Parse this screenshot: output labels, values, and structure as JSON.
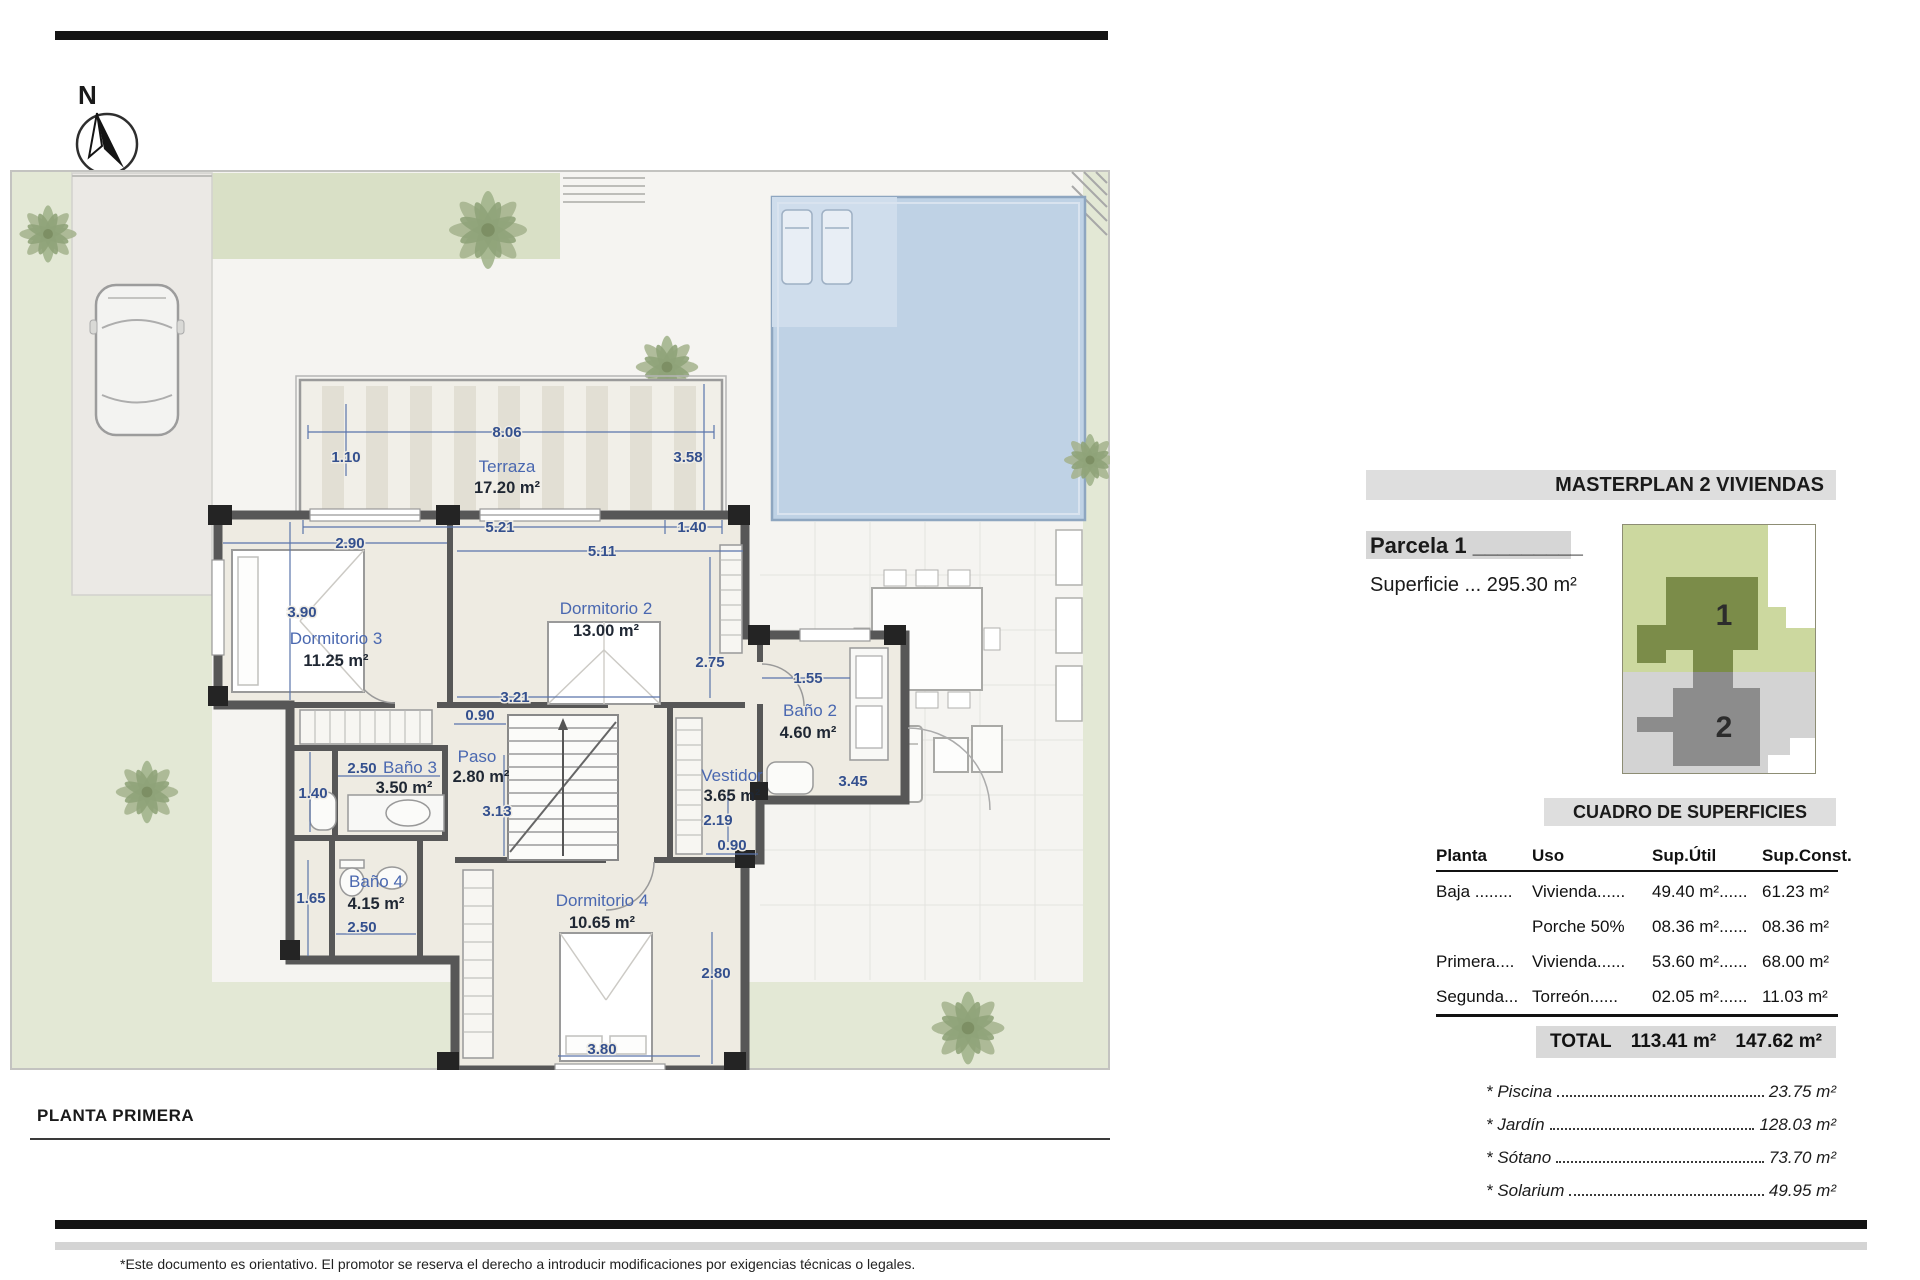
{
  "compass": {
    "north_label": "N"
  },
  "plan": {
    "title": "PLANTA PRIMERA",
    "rooms": {
      "terraza": {
        "name": "Terraza",
        "area": "17.20 m²"
      },
      "dorm3": {
        "name": "Dormitorio 3",
        "area": "11.25 m²"
      },
      "dorm2": {
        "name": "Dormitorio 2",
        "area": "13.00 m²"
      },
      "bano2": {
        "name": "Baño 2",
        "area": "4.60 m²"
      },
      "bano3": {
        "name": "Baño 3",
        "area": "3.50 m²"
      },
      "paso": {
        "name": "Paso",
        "area": "2.80 m²"
      },
      "vestidor": {
        "name": "Vestidor",
        "area": "3.65 m²"
      },
      "bano4": {
        "name": "Baño 4",
        "area": "4.15 m²"
      },
      "dorm4": {
        "name": "Dormitorio 4",
        "area": "10.65 m²"
      }
    },
    "dims": {
      "d806": "8.06",
      "d110": "1.10",
      "d358": "3.58",
      "d521": "5.21",
      "d140a": "1.40",
      "d290": "2.90",
      "d390": "3.90",
      "d511": "5.11",
      "d321": "3.21",
      "d275": "2.75",
      "d155": "1.55",
      "d345": "3.45",
      "d090a": "0.90",
      "d250a": "2.50",
      "d140b": "1.40",
      "d313": "3.13",
      "d219": "2.19",
      "d090b": "0.90",
      "d165": "1.65",
      "d250b": "2.50",
      "d280": "2.80",
      "d380": "3.80"
    }
  },
  "panel": {
    "masterplan_title": "MASTERPLAN 2 VIVIENDAS",
    "parcela": "Parcela 1 _________",
    "superficie": "Superficie ... 295.30 m²",
    "plot1": "1",
    "plot2": "2",
    "cuadro_title": "CUADRO DE SUPERFICIES",
    "table": {
      "headers": [
        "Planta",
        "Uso",
        "Sup.Útil",
        "Sup.Const."
      ],
      "rows": [
        [
          "Baja ........",
          "Vivienda......",
          "49.40 m²......",
          "61.23 m²"
        ],
        [
          "",
          "Porche 50%",
          "08.36 m²......",
          "08.36 m²"
        ],
        [
          "Primera....",
          "Vivienda......",
          "53.60 m²......",
          "68.00 m²"
        ],
        [
          "Segunda...",
          "Torreón......",
          "02.05 m²......",
          "11.03 m²"
        ]
      ]
    },
    "total": {
      "label": "TOTAL",
      "util": "113.41 m²",
      "constr": "147.62 m²"
    },
    "extras": [
      {
        "label": "* Piscina",
        "value": "23.75 m²"
      },
      {
        "label": "* Jardín",
        "value": "128.03 m²"
      },
      {
        "label": "* Sótano",
        "value": "73.70 m²"
      },
      {
        "label": "* Solarium",
        "value": "49.95 m²"
      }
    ]
  },
  "footer": {
    "note": "*Este documento es orientativo. El promotor se reserva el derecho a introducir modificaciones por exigencias técnicas o legales."
  }
}
